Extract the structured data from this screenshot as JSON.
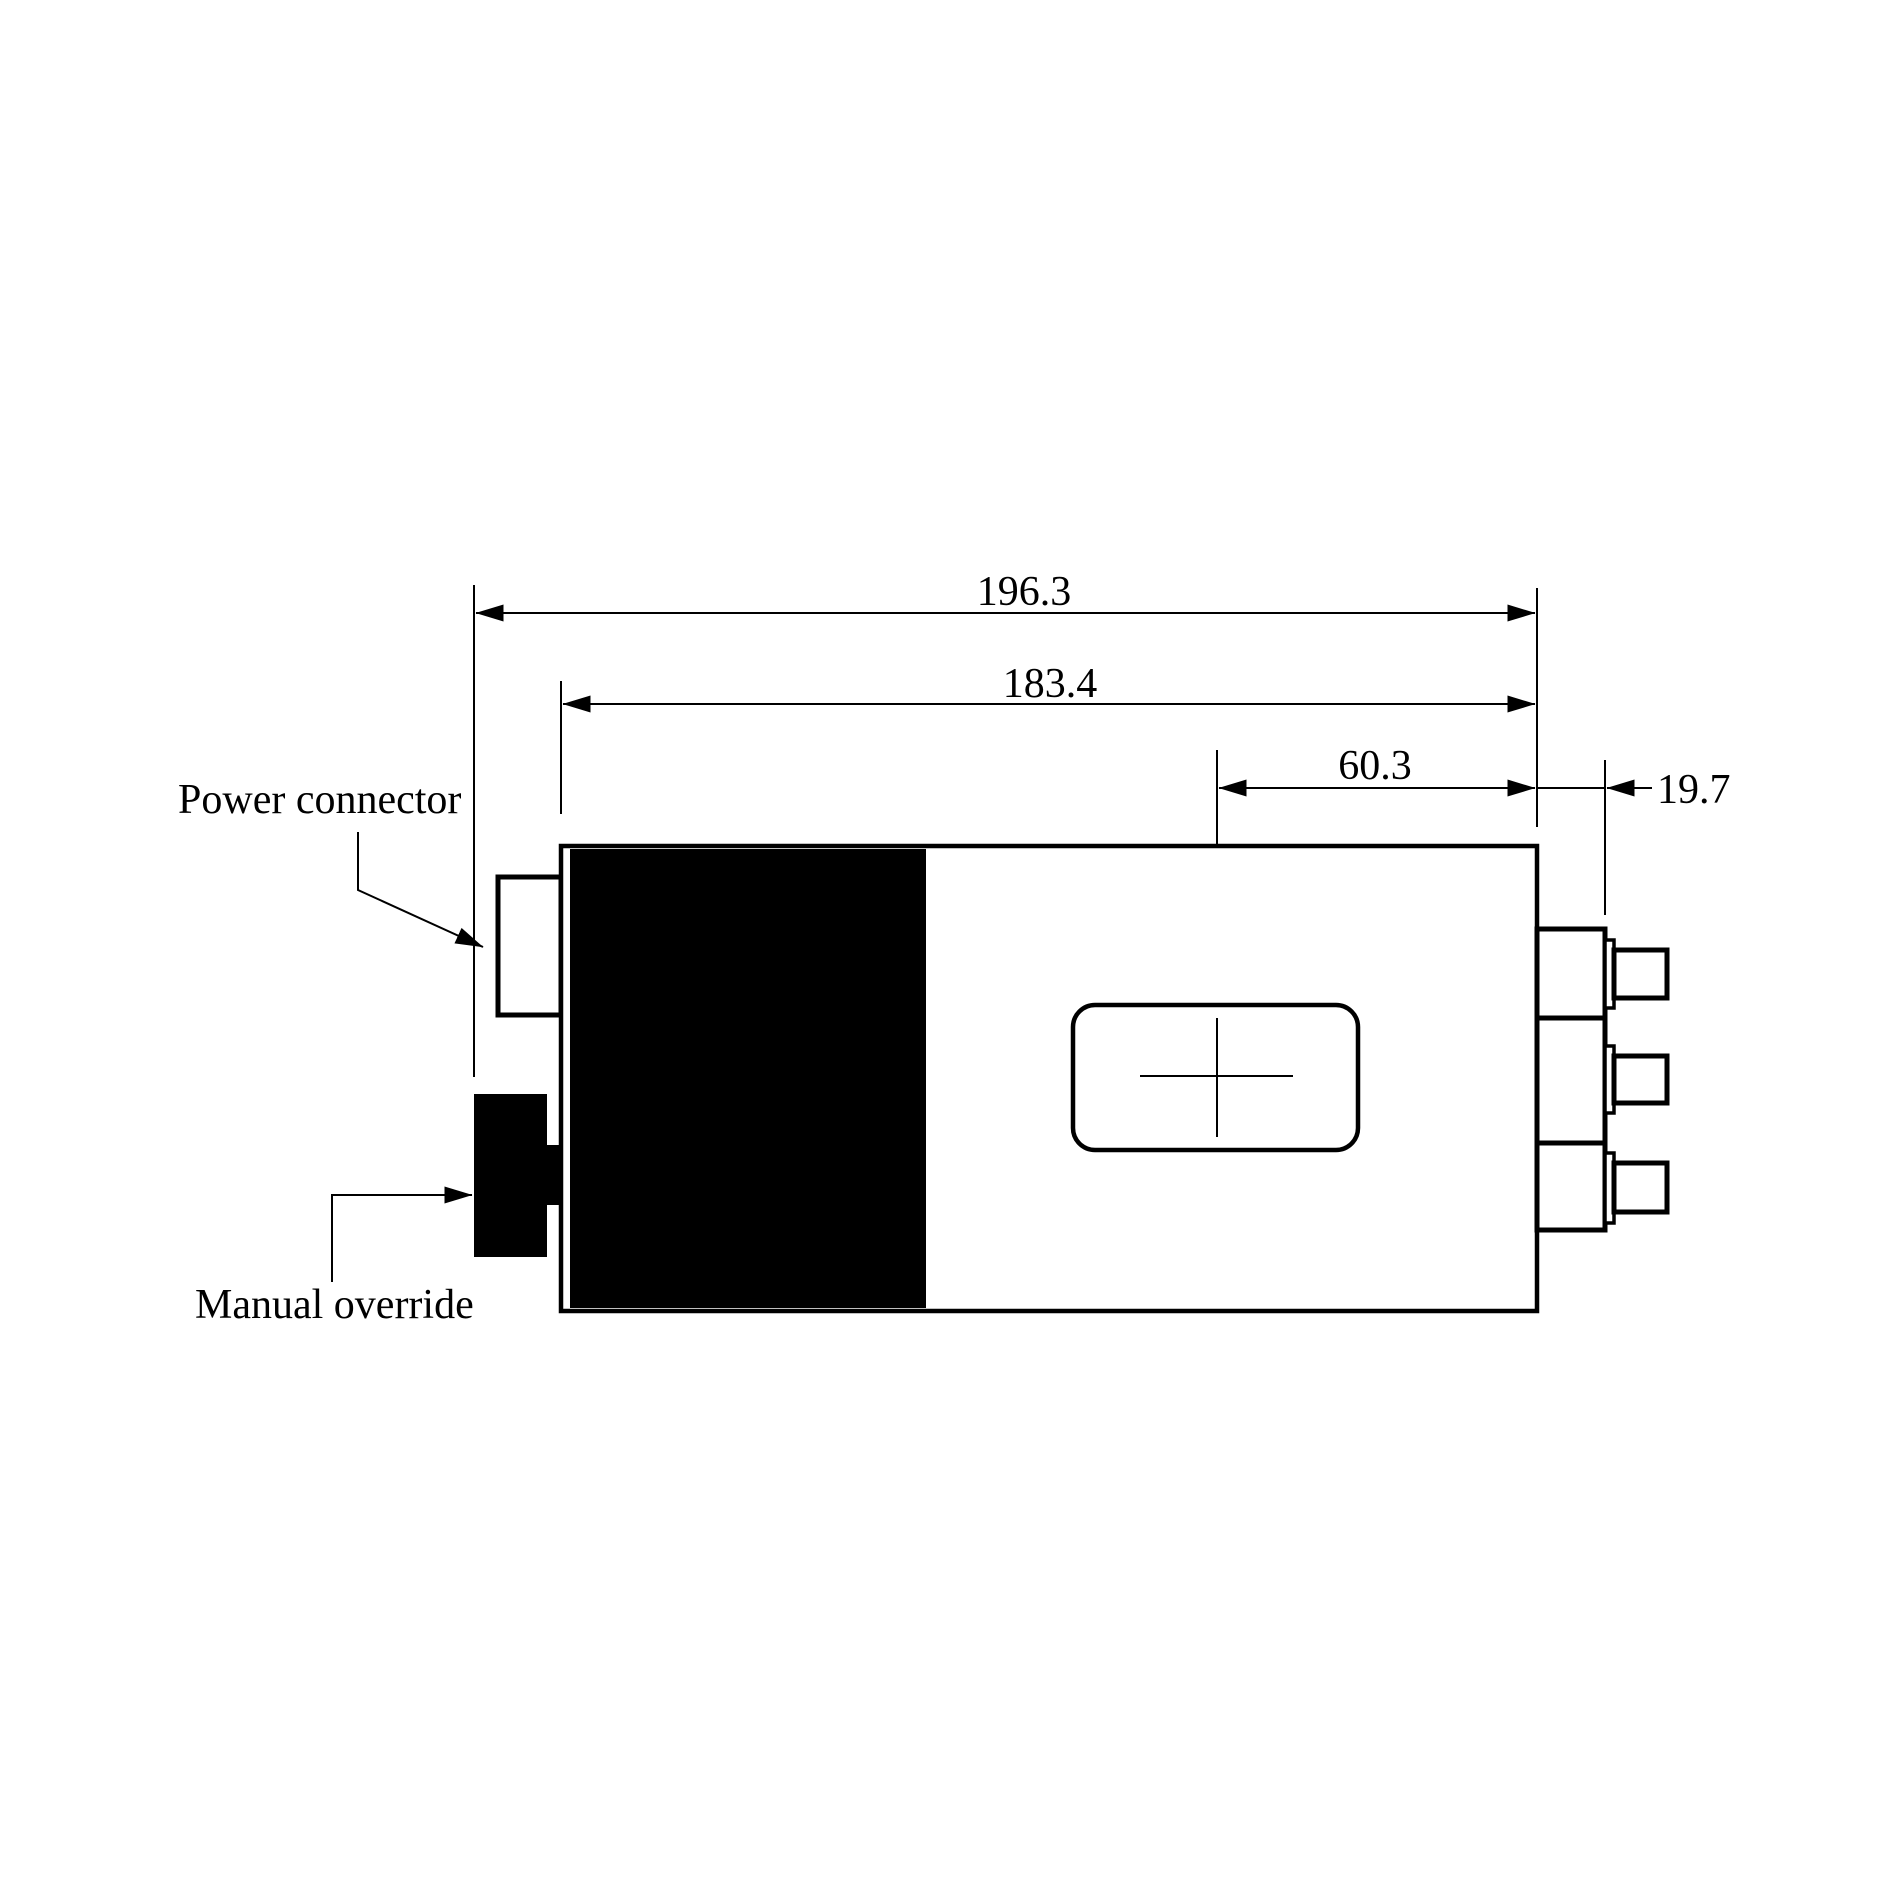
{
  "drawing": {
    "annotations": {
      "power_connector": "Power connector",
      "manual_override": "Manual override"
    },
    "dimensions": {
      "overall_length": "196.3",
      "body_length": "183.4",
      "window_center_offset": "60.3",
      "connector_protrusion": "19.7"
    },
    "colors": {
      "ink": "#000000",
      "paper": "#ffffff"
    }
  }
}
